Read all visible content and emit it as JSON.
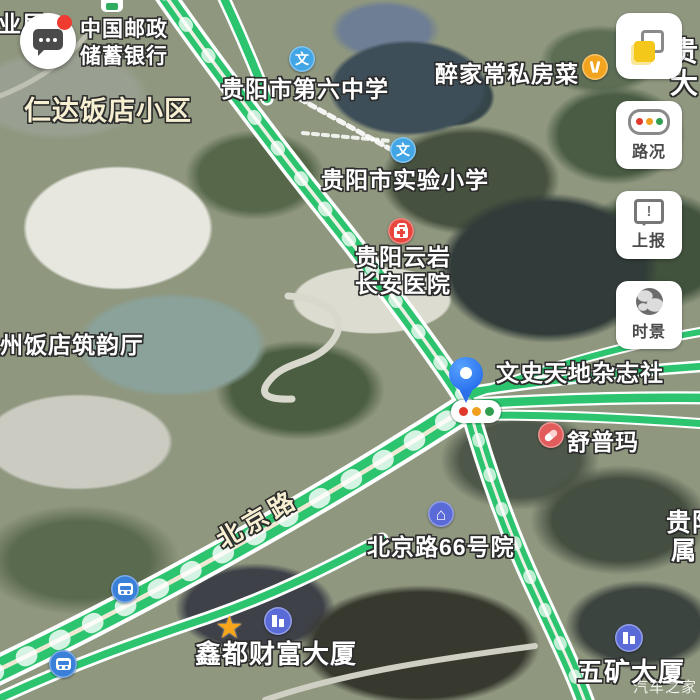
{
  "watermark": "汽车之家",
  "labels": {
    "bureau": "业局",
    "post_bank_line1": "中国邮政",
    "post_bank_line2": "储蓄银行",
    "renda": "仁达饭店小区",
    "school6": "贵阳市第六中学",
    "restaurant": "醉家常私房菜",
    "primary_school": "贵阳市实验小学",
    "hospital_line1": "贵阳云岩",
    "hospital_line2": "长安医院",
    "hotel_hall": "州饭店筑韵厅",
    "magazine": "文史天地杂志社",
    "shupuma": "舒普玛",
    "beijing_road": "北京路",
    "courtyard66": "北京路66号院",
    "xindu_tower": "鑫都财富大厦",
    "wukuang_tower": "五矿大厦",
    "edge_top_line1": "贵",
    "edge_top_line2": "大",
    "edge_right_line1": "贵阳",
    "edge_right_line2": "属",
    "school_icon_glyph": "文"
  },
  "buttons": {
    "traffic_label": "路况",
    "report_label": "上报",
    "scene_label": "时景"
  },
  "icons": {
    "star_glyph": "★",
    "house_glyph": "⌂",
    "exclamation_glyph": "!"
  },
  "colors": {
    "traffic_green": "#2cc46f",
    "accent_yellow": "#f3c81a",
    "pin_blue": "#2f7cf6",
    "school_blue": "#42a5e5",
    "hospital_red": "#e8463c",
    "restaurant_orange": "#f2a41f",
    "building_purple": "#5a6bd8",
    "bus_blue": "#3a80d9",
    "signal_red": "#e0392c",
    "signal_orange": "#f0a01e",
    "signal_green": "#2f9e4f"
  }
}
